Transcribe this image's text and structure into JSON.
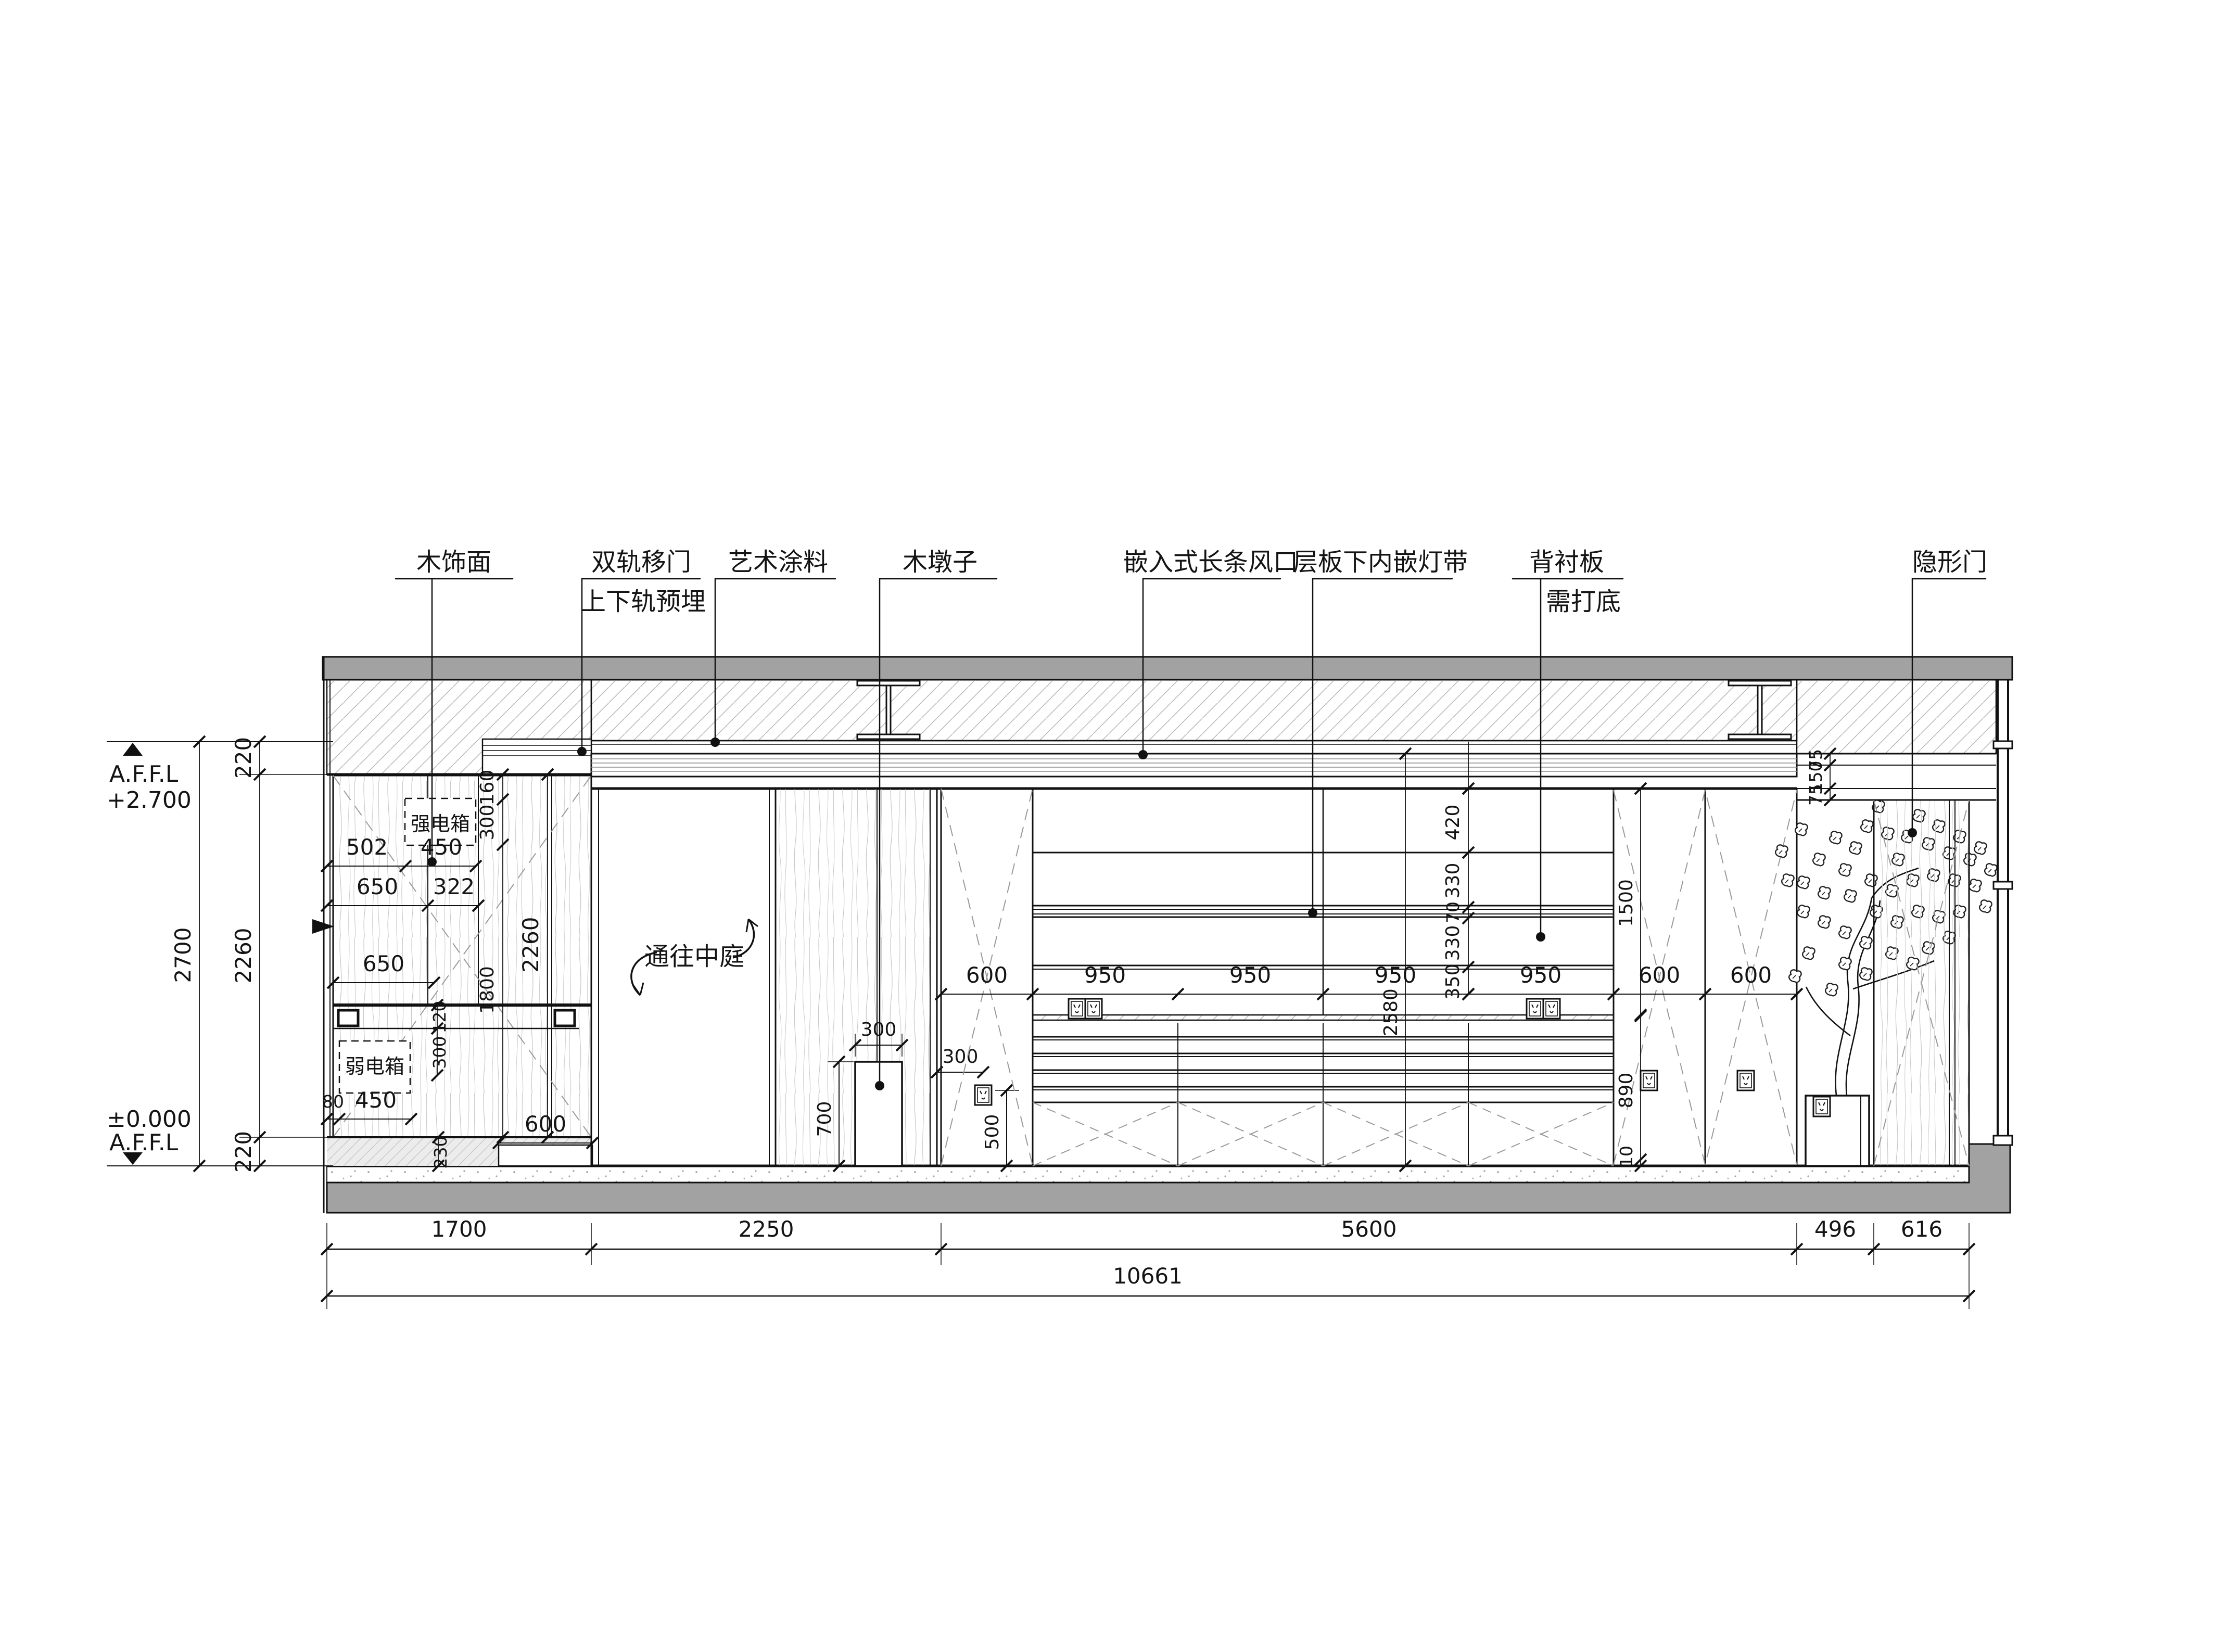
{
  "labels": [
    {
      "text": "木饰面",
      "text2": ""
    },
    {
      "text": "双轨移门",
      "text2": "上下轨预埋"
    },
    {
      "text": "艺术涂料",
      "text2": ""
    },
    {
      "text": "木墩子",
      "text2": ""
    },
    {
      "text": "嵌入式长条风口",
      "text2": ""
    },
    {
      "text": "层板下内嵌灯带",
      "text2": ""
    },
    {
      "text": "背衬板",
      "text2": "需打底"
    },
    {
      "text": "隐形门",
      "text2": ""
    }
  ],
  "levels": {
    "top_label": "A.F.F.L",
    "top_value": "+2.700",
    "bottom_value": "±0.000",
    "bottom_label": "A.F.F.L"
  },
  "left_dims": {
    "total": "2700",
    "seg_top": "220",
    "seg_mid": "2260",
    "seg_bot": "220"
  },
  "bottom_dims": {
    "d1": "1700",
    "d2": "2250",
    "d3": "5600",
    "d4": "496",
    "d5": "616",
    "total": "10661"
  },
  "cabinet_dims": {
    "d502": "502",
    "d450": "450",
    "d650a": "650",
    "d322": "322",
    "d650b": "650",
    "v160": "160",
    "v300a": "300",
    "v2260": "2260",
    "v1800": "1800",
    "v120": "120",
    "v300b": "300",
    "d80": "80",
    "d450b": "450",
    "d600toe": "600",
    "v230": "230"
  },
  "boxes": {
    "strong": "强电箱",
    "weak": "弱电箱"
  },
  "opening": {
    "note": "通往中庭"
  },
  "block_dims": {
    "w": "300",
    "h": "700"
  },
  "socket_dims": {
    "off": "300",
    "h": "500"
  },
  "shelf_dims": {
    "bays": [
      "600",
      "950",
      "950",
      "950",
      "950",
      "600",
      "600"
    ],
    "stack": [
      "420",
      "330",
      "70",
      "330",
      "350"
    ],
    "v2580": "2580",
    "v1500": "1500",
    "v890": "890",
    "v10": "10",
    "head": [
      "75",
      "150",
      "75"
    ]
  }
}
